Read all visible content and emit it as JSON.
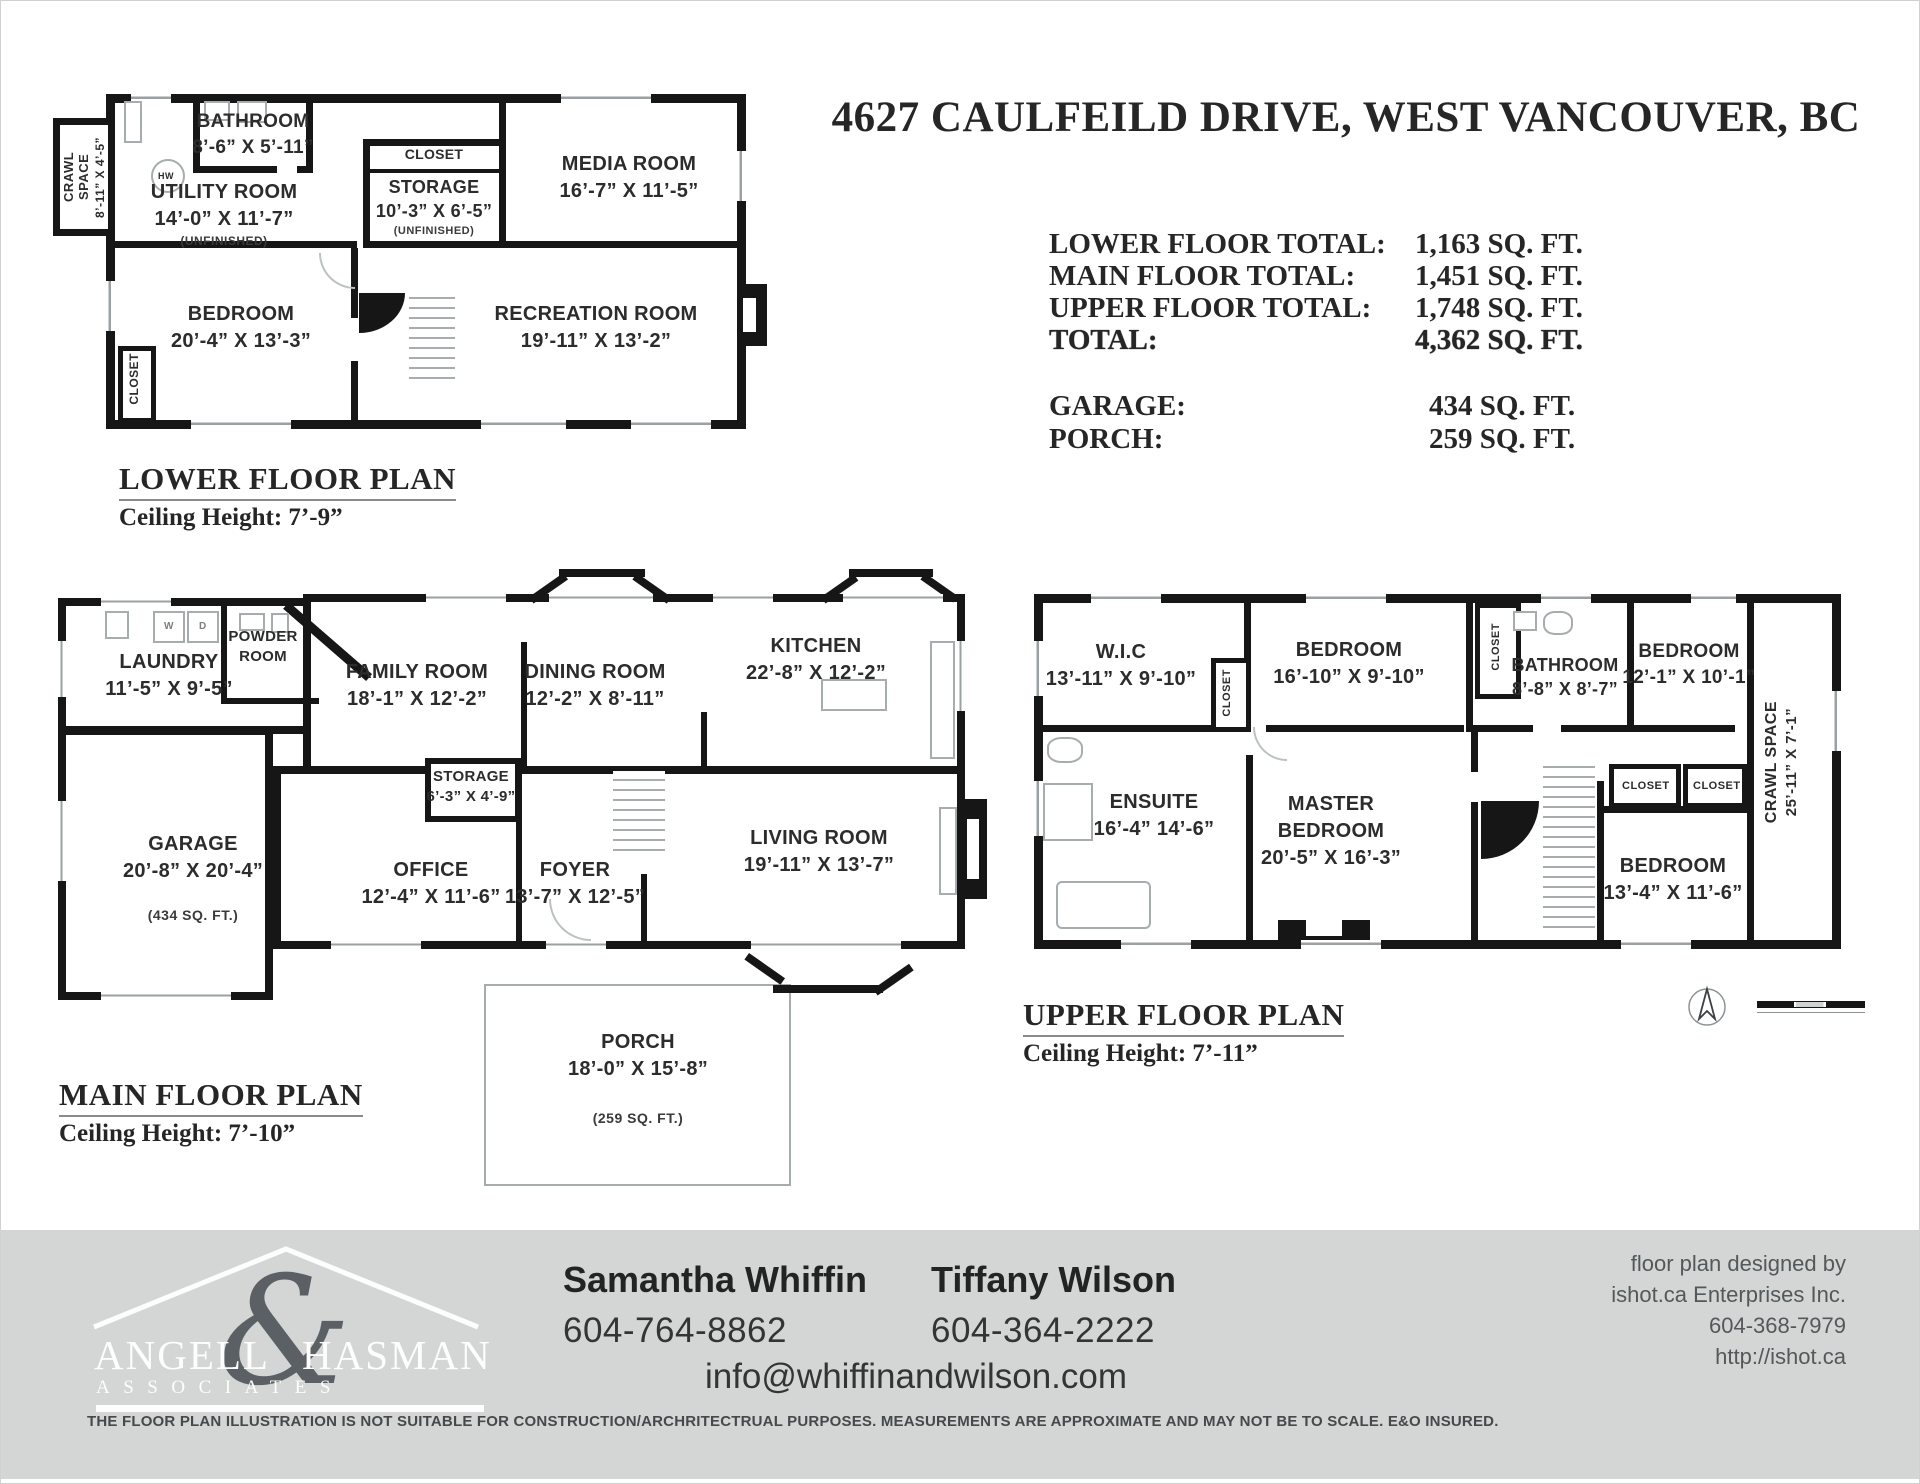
{
  "title": "4627 CAULFEILD DRIVE, WEST VANCOUVER, BC",
  "summary": {
    "rows": [
      {
        "label": "LOWER FLOOR TOTAL:",
        "value": "1,163 SQ. FT."
      },
      {
        "label": "MAIN FLOOR TOTAL:",
        "value": "1,451 SQ. FT."
      },
      {
        "label": "UPPER FLOOR TOTAL:",
        "value": "1,748 SQ. FT."
      },
      {
        "label": "TOTAL:",
        "value": "4,362 SQ. FT."
      }
    ],
    "extra": [
      {
        "label": "GARAGE:",
        "value": "434 SQ. FT."
      },
      {
        "label": "PORCH:",
        "value": "259 SQ. FT."
      }
    ]
  },
  "lower": {
    "label": "LOWER FLOOR PLAN",
    "ceiling": "Ceiling Height: 7’-9”",
    "rooms": {
      "crawl": {
        "name": "CRAWL SPACE",
        "dims": "8’-11” X 4’-5”"
      },
      "bathroom": {
        "name": "BATHROOM",
        "dims": "8’-6” X 5’-11”"
      },
      "utility": {
        "name": "UTILITY ROOM",
        "dims": "14’-0” X 11’-7”",
        "note": "(UNFINISHED)"
      },
      "hw": "HW",
      "storage_closet": "CLOSET",
      "storage": {
        "name": "STORAGE",
        "dims": "10’-3” X 6’-5”",
        "note": "(UNFINISHED)"
      },
      "media": {
        "name": "MEDIA ROOM",
        "dims": "16’-7” X 11’-5”"
      },
      "bedroom": {
        "name": "BEDROOM",
        "dims": "20’-4” X 13’-3”"
      },
      "recreation": {
        "name": "RECREATION ROOM",
        "dims": "19’-11” X 13’-2”"
      },
      "closet": "CLOSET"
    }
  },
  "main": {
    "label": "MAIN FLOOR PLAN",
    "ceiling": "Ceiling Height: 7’-10”",
    "rooms": {
      "laundry": {
        "name": "LAUNDRY",
        "dims": "11’-5” X 9’-5”"
      },
      "powder": {
        "line1": "POWDER",
        "line2": "ROOM"
      },
      "washer": "W",
      "dryer": "D",
      "family": {
        "name": "FAMILY ROOM",
        "dims": "18’-1” X 12’-2”"
      },
      "dining": {
        "name": "DINING ROOM",
        "dims": "12’-2” X 8’-11”"
      },
      "kitchen": {
        "name": "KITCHEN",
        "dims": "22’-8” X 12’-2”"
      },
      "garage": {
        "name": "GARAGE",
        "dims": "20’-8” X 20’-4”",
        "note": "(434 SQ. FT.)"
      },
      "storage": {
        "name": "STORAGE",
        "dims": "6’-3” X 4’-9”"
      },
      "office": {
        "name": "OFFICE",
        "dims": "12’-4” X 11’-6”"
      },
      "foyer": {
        "name": "FOYER",
        "dims": "13’-7” X 12’-5”"
      },
      "living": {
        "name": "LIVING ROOM",
        "dims": "19’-11” X 13’-7”"
      },
      "porch": {
        "name": "PORCH",
        "dims": "18’-0” X 15’-8”",
        "note": "(259 SQ. FT.)"
      }
    }
  },
  "upper": {
    "label": "UPPER FLOOR PLAN",
    "ceiling": "Ceiling Height: 7’-11”",
    "rooms": {
      "wic": {
        "name": "W.I.C",
        "dims": "13’-11” X 9’-10”"
      },
      "bedroom1": {
        "name": "BEDROOM",
        "dims": "16’-10” X 9’-10”"
      },
      "bathroom": {
        "name": "BATHROOM",
        "dims": "8’-8” X 8’-7”"
      },
      "bedroom2": {
        "name": "BEDROOM",
        "dims": "12’-1” X 10’-1”"
      },
      "crawl": {
        "name": "CRAWL SPACE",
        "dims": "25’-11” X 7’-1”"
      },
      "ensuite": {
        "name": "ENSUITE",
        "dims": "16’-4” 14’-6”"
      },
      "master": {
        "line1": "MASTER",
        "line2": "BEDROOM",
        "dims": "20’-5” X 16’-3”"
      },
      "bedroom3": {
        "name": "BEDROOM",
        "dims": "13’-4” X 11’-6”"
      },
      "closet": "CLOSET"
    }
  },
  "footer": {
    "logo": {
      "word1": "ANGELL",
      "amp": "&",
      "word2": "HASMAN",
      "sub": "ASSOCIATES"
    },
    "agents": [
      {
        "name": "Samantha Whiffin",
        "phone": "604-764-8862"
      },
      {
        "name": "Tiffany Wilson",
        "phone": "604-364-2222"
      }
    ],
    "email": "info@whiffinandwilson.com",
    "credit": {
      "l1": "floor plan designed by",
      "l2": "ishot.ca Enterprises Inc.",
      "l3": "604-368-7979",
      "l4": "http://ishot.ca"
    },
    "disclaimer": "THE FLOOR PLAN ILLUSTRATION IS NOT SUITABLE FOR CONSTRUCTION/ARCHRITECTRUAL PURPOSES. MEASUREMENTS ARE APPROXIMATE AND MAY NOT BE TO SCALE. E&O INSURED."
  },
  "colors": {
    "wall": "#161616",
    "footer_bg": "#d3d6d5",
    "logo_amp": "#5a6063"
  }
}
